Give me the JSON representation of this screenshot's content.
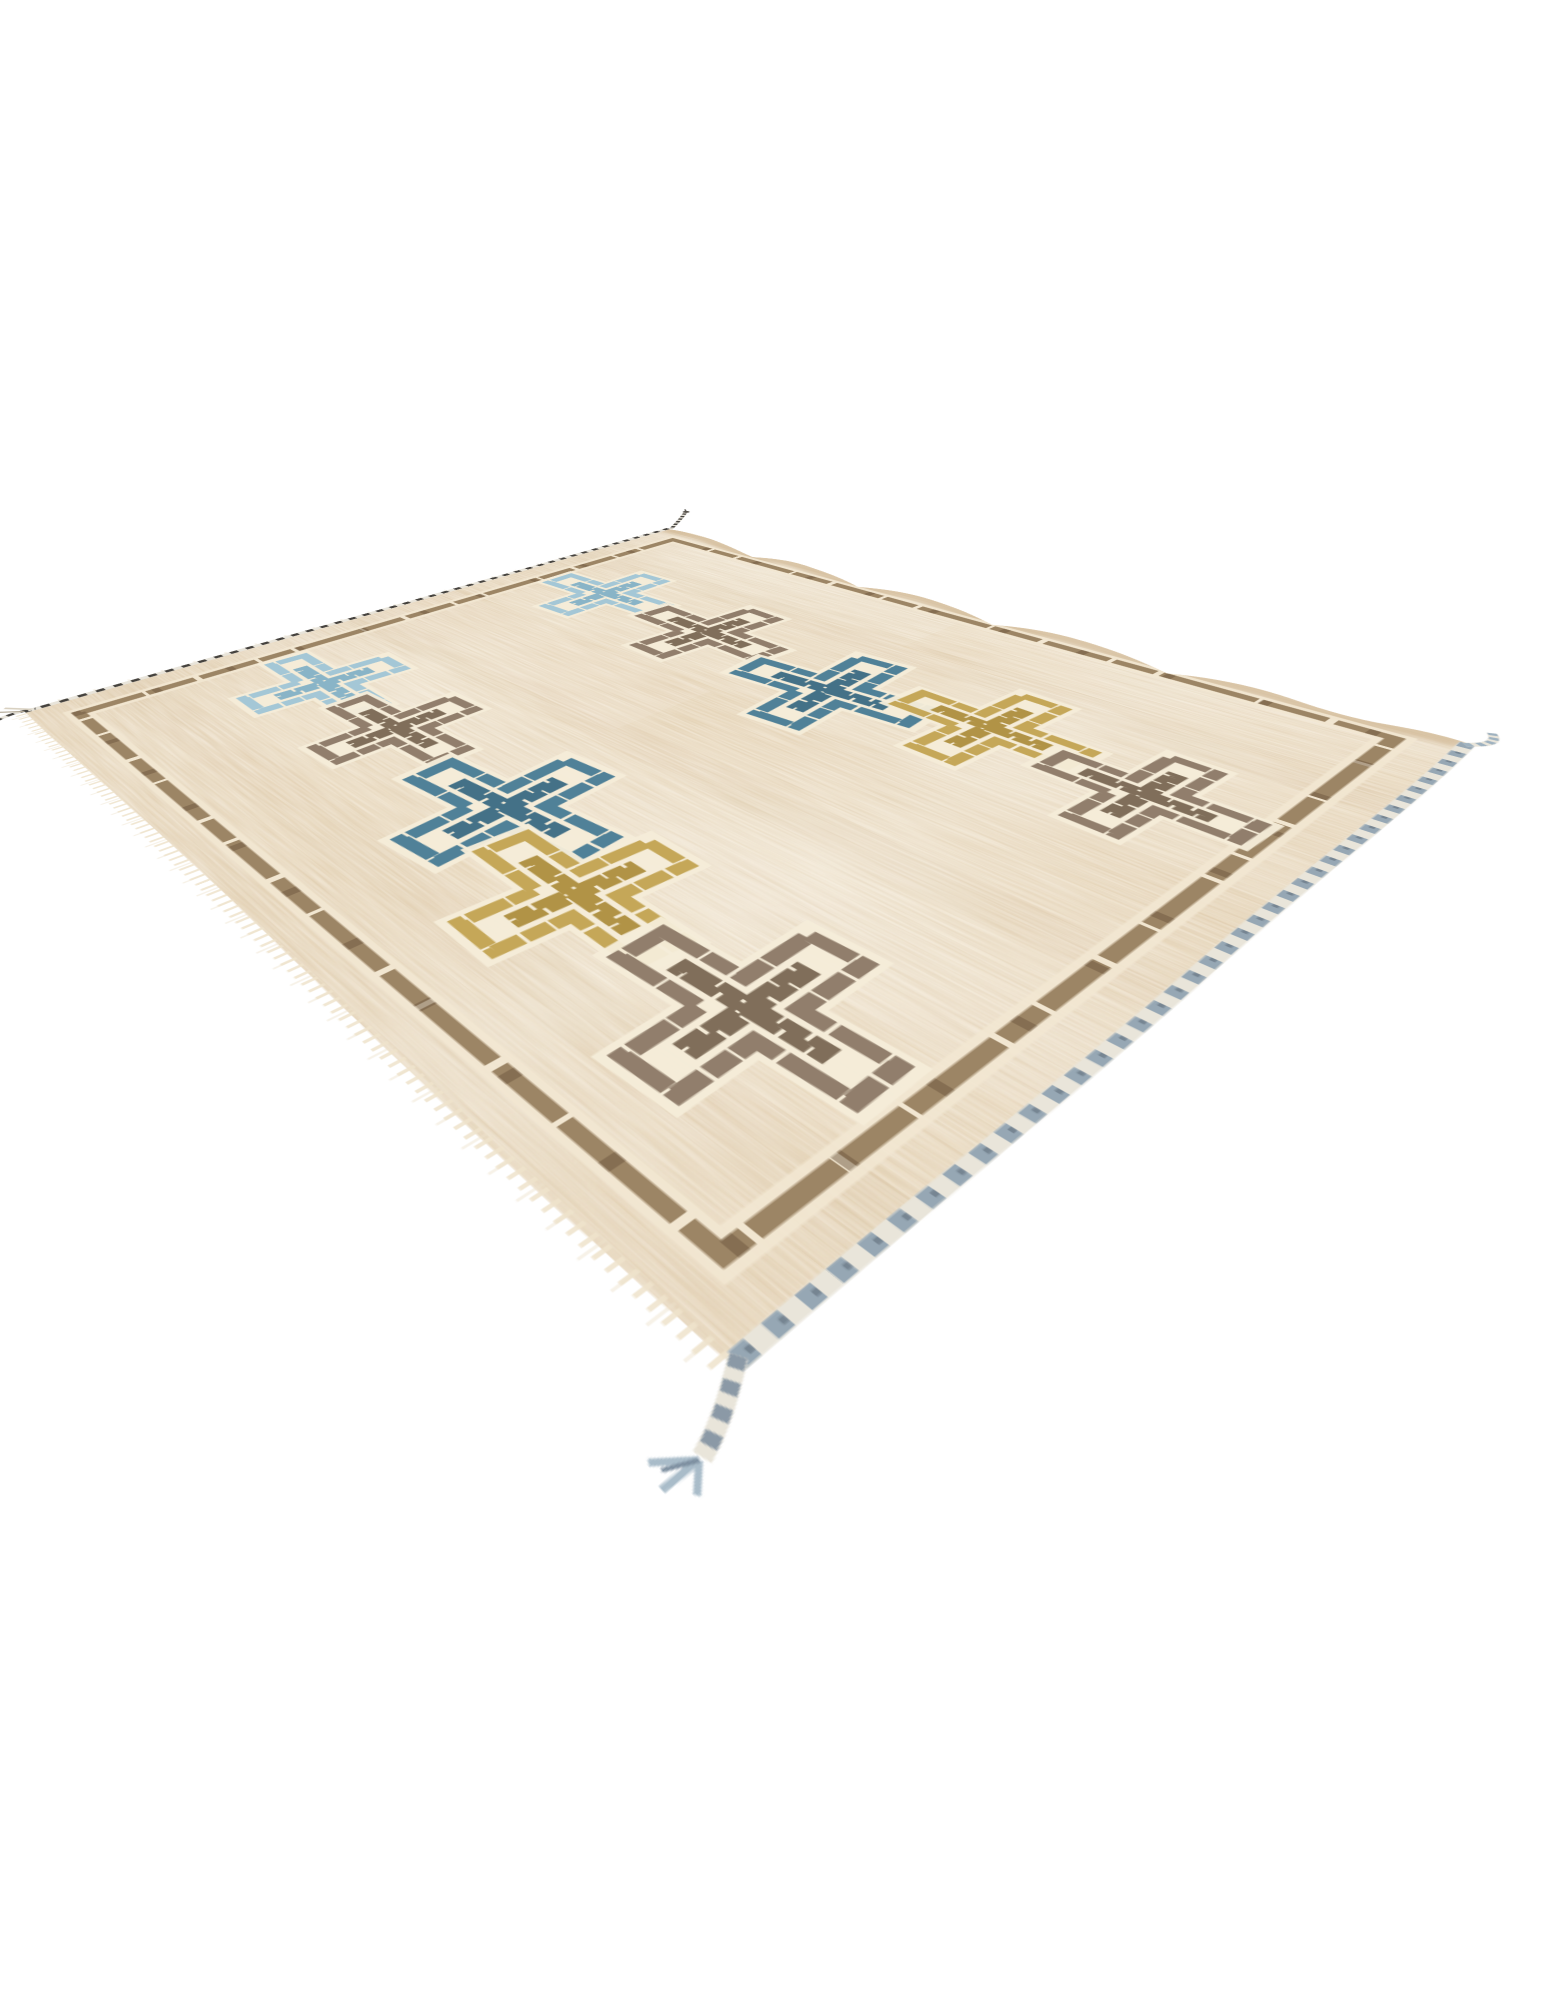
{
  "scene": {
    "background": "#ffffff",
    "subject": "Hand-woven beige flat-weave kilim area rug photographed at an angle on a seamless white background",
    "view": "perspective product shot, no text or UI elements"
  },
  "rug": {
    "motif": "outlined cross with inner key line on cream halo",
    "rows": 2,
    "crosses_per_row": 5,
    "colors": {
      "field": "#e7d6b9",
      "cream": "#f5ecd8",
      "cream_margin": "#f2e7d1",
      "border": "#97805f",
      "border_fleck": "#6d573f",
      "edge_tan": "#c1a176",
      "cord_dark": "#45423e",
      "cord_light": "#e8e4da",
      "braid": "#96a7b4",
      "braid_light": "#e9e5da",
      "braid_soft": "#a9bcc9",
      "fringe": "#eee3cb"
    },
    "palette": {
      "light_blue": {
        "main": "#9fc5d6",
        "inner": "#83b1c6"
      },
      "teal": {
        "main": "#477b95",
        "inner": "#3a6a83"
      },
      "gold": {
        "main": "#c2a351",
        "inner": "#ad8e3e"
      },
      "brown": {
        "main": "#8b7866",
        "inner": "#796753"
      }
    },
    "crosses": [
      {
        "color": "light_blue",
        "x": 152,
        "y": 281,
        "s": 1.0,
        "r": -2
      },
      {
        "color": "brown",
        "x": 339,
        "y": 291,
        "s": 1.05,
        "r": 3
      },
      {
        "color": "teal",
        "x": 542,
        "y": 327,
        "s": 1.12,
        "r": -6
      },
      {
        "color": "gold",
        "x": 700,
        "y": 288,
        "s": 1.02,
        "r": 2
      },
      {
        "color": "brown",
        "x": 860,
        "y": 313,
        "s": 0.95,
        "r": 2
      },
      {
        "color": "light_blue",
        "x": 157,
        "y": 714,
        "s": 1.02,
        "r": 2
      },
      {
        "color": "brown",
        "x": 309,
        "y": 720,
        "s": 0.98,
        "r": -2
      },
      {
        "color": "teal",
        "x": 512,
        "y": 740,
        "s": 1.15,
        "r": -5
      },
      {
        "color": "gold",
        "x": 655,
        "y": 786,
        "s": 1.08,
        "r": 3
      },
      {
        "color": "brown",
        "x": 833,
        "y": 792,
        "s": 1.1,
        "r": -2
      }
    ]
  }
}
